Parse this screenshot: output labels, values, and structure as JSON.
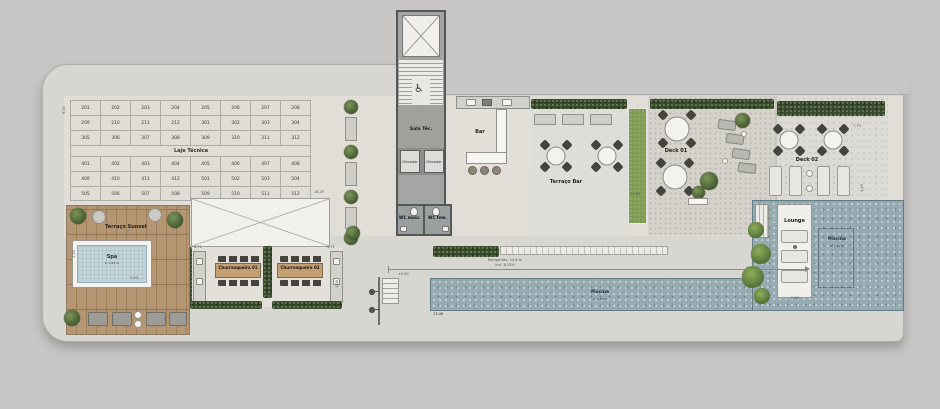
{
  "plan": {
    "laje": {
      "label": "Laje Técnica",
      "dim_height": "6,04",
      "rows": [
        {
          "c": [
            "201",
            "202",
            "203",
            "204",
            "205",
            "206",
            "207",
            "208"
          ]
        },
        {
          "c": [
            "209",
            "210",
            "211",
            "212",
            "301",
            "302",
            "303",
            "304"
          ]
        },
        {
          "c": [
            "305",
            "306",
            "307",
            "308",
            "309",
            "310",
            "311",
            "312"
          ]
        },
        {
          "c": [
            "401",
            "402",
            "403",
            "404",
            "405",
            "406",
            "407",
            "408"
          ]
        },
        {
          "c": [
            "409",
            "410",
            "411",
            "412",
            "501",
            "502",
            "503",
            "504"
          ]
        },
        {
          "c": [
            "505",
            "506",
            "507",
            "508",
            "509",
            "510",
            "511",
            "512"
          ]
        }
      ]
    },
    "pergola": {
      "dim": "18,29"
    },
    "sunset": {
      "label": "Terraço Sunset"
    },
    "spa": {
      "label": "Spa",
      "depth": "h: 0,50 m",
      "dim_width": "4,93",
      "dim_side": "2,30"
    },
    "churrasqueiras": {
      "c1": "Churrasqueira 01",
      "c2": "Churrasqueira 02",
      "dim_left": "4,71",
      "dim_right": "4,71",
      "dim_side": "3,08"
    },
    "core": {
      "sala_tecnica": "Sala Téc.",
      "elevador_1": "Elevador",
      "elevador_2": "Elevador",
      "wc_masc": "WC masc.",
      "wc_fem": "WC fem.",
      "accessibility_symbol": "♿"
    },
    "bar": {
      "label": "Bar"
    },
    "terraco_bar": {
      "label": "Terraço Bar",
      "dim": "11,63"
    },
    "deck01": {
      "label": "Deck 01"
    },
    "deck02": {
      "label": "Deck 02",
      "dim_top": "7,75",
      "dim_side": "4,40"
    },
    "lounge": {
      "label": "Lounge",
      "dim": "2,26"
    },
    "piscina_main": {
      "label": "Piscina",
      "depth": "h: 1,30 m",
      "dim": "13,46"
    },
    "piscina_raia": {
      "label": "Piscina",
      "depth": "h: 1,30 m"
    },
    "rampa": {
      "line1": "Rampa des. 14,4 m",
      "line2": "incl. 8,33%",
      "level": "±0,00"
    }
  },
  "colors": {
    "background": "#c7c6c4",
    "plate": "#d8d6d0",
    "water": "#96aab1",
    "hedge_green": "#3a4a30",
    "grass_green": "#7e9c53",
    "wood_deck": "#b59674",
    "wall_gray": "#55565a"
  }
}
